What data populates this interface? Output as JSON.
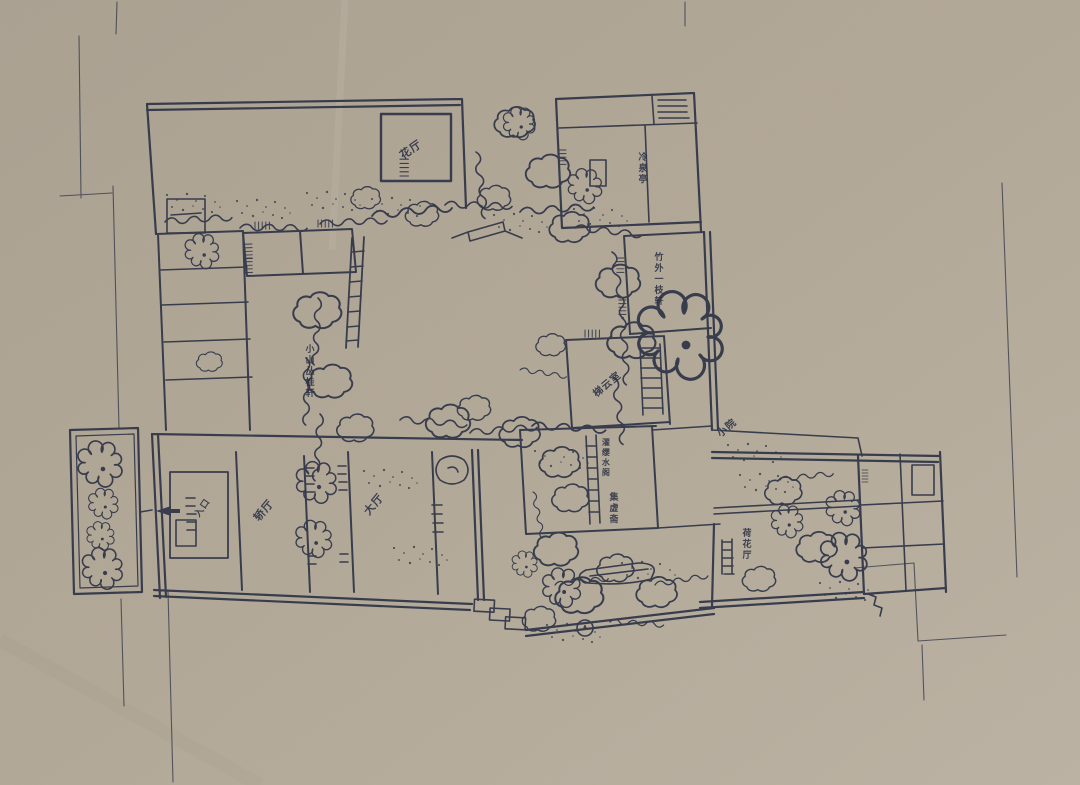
{
  "drawing": {
    "kind": "hand-drawn ink floor plan of a classical Chinese courtyard garden on kraft paper"
  },
  "colors": {
    "paper": "#b2a897",
    "paper_light": "#c6beb1",
    "paper_dark": "#a1998c",
    "ink": "#2e3447",
    "ink_faint": "#4a5168"
  },
  "labels": [
    {
      "id": "hall-northwest",
      "text": "花厅"
    },
    {
      "id": "room-northeast",
      "text": "冷泉亭"
    },
    {
      "id": "gallery-east",
      "text": "竹外一枝轩"
    },
    {
      "id": "hall-southwest",
      "text": "小山丛桂轩"
    },
    {
      "id": "stair-hall",
      "text": "梯云室"
    },
    {
      "id": "water-pavilion",
      "text": "濯缨水阁"
    },
    {
      "id": "studio",
      "text": "集虚斋"
    },
    {
      "id": "small-court",
      "text": "小院"
    },
    {
      "id": "lotus-hall",
      "text": "荷花厅"
    },
    {
      "id": "sedan-hall",
      "text": "轿厅"
    },
    {
      "id": "main-hall",
      "text": "大厅"
    },
    {
      "id": "entrance",
      "text": "入口"
    }
  ]
}
